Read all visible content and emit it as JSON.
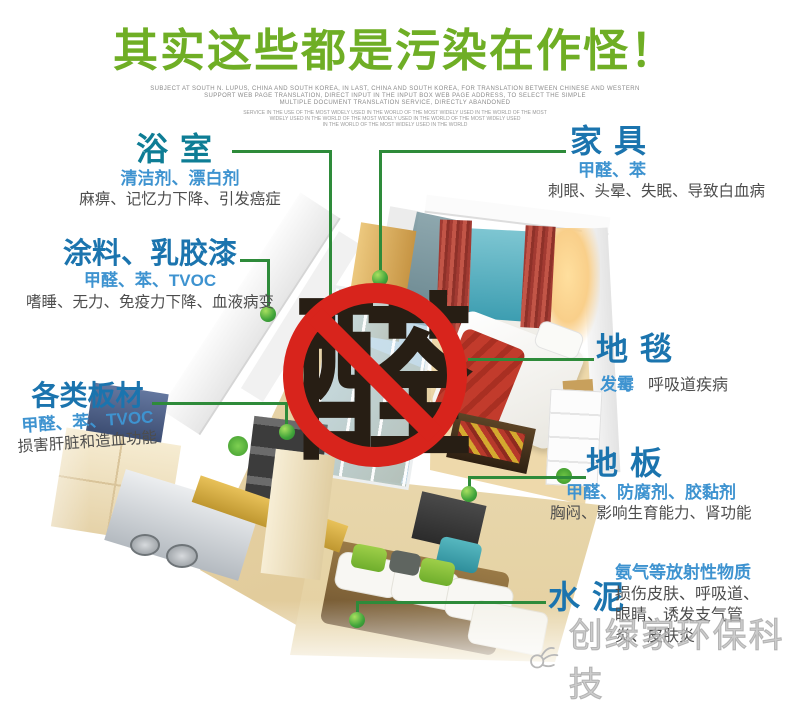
{
  "title": {
    "text": "其实这些都是污染在作怪！"
  },
  "fine_print": {
    "lines": [
      "SUBJECT AT SOUTH N. LUPUS, CHINA AND SOUTH KOREA, IN LAST, CHINA AND SOUTH KOREA, FOR TRANSLATION BETWEEN CHINESE AND WESTERN",
      "SUPPORT WEB PAGE TRANSLATION, DIRECT INPUT IN THE INPUT BOX WEB PAGE ADDRESS, TO SELECT THE SIMPLE",
      "MULTIPLE DOCUMENT TRANSLATION SERVICE, DIRECTLY ABANDONED"
    ],
    "small_lines": [
      "SERVICE IN THE USE OF THE MOST WIDELY USED IN THE WORLD OF THE MOST WIDELY USED IN THE WORLD OF THE MOST",
      "WIDELY USED IN THE WORLD OF THE MOST WIDELY USED IN THE WORLD OF THE MOST WIDELY USED",
      "IN THE WORLD OF THE MOST WIDELY USED IN THE WORLD"
    ]
  },
  "center_sign": {
    "character": "醛"
  },
  "labels": {
    "bathroom": {
      "name": "浴室",
      "sources": "清洁剂、漂白剂",
      "effects": "麻痹、记忆力下降、引发癌症"
    },
    "paint": {
      "name": "涂料、乳胶漆",
      "sources": "甲醛、苯、TVOC",
      "effects": "嗜睡、无力、免疫力下降、血液病变"
    },
    "boards": {
      "name": "各类板材",
      "sources": "甲醛、苯、TVOC",
      "effects": "损害肝脏和造血功能"
    },
    "furniture": {
      "name": "家具",
      "sources": "甲醛、苯",
      "effects": "刺眼、头晕、失眠、导致白血病"
    },
    "carpet": {
      "name": "地毯",
      "sources": "发霉",
      "effects": "呼吸道疾病"
    },
    "floor": {
      "name": "地板",
      "sources": "甲醛、防腐剂、胶黏剂",
      "effects": "胸闷、影响生育能力、肾功能"
    },
    "cement": {
      "name": "水泥",
      "sources": "氨气等放射性物质",
      "effects_lines": [
        "损伤皮肤、呼吸道、",
        "眼睛、诱发支气管",
        "炎、皮肤炎"
      ]
    }
  },
  "watermark": {
    "text": "创绿家环保科技"
  },
  "colors": {
    "title_green": "#6fae25",
    "header_teal": "#0e7d95",
    "header_blue": "#1b74ae",
    "source_blue": "#3e93d0",
    "effects_gray": "#4d4d4d",
    "connector_green": "#2e8b3a",
    "ban_red": "#d8241c",
    "ban_char_dark": "#271e14",
    "watermark_gray": "#bdbdbd"
  }
}
